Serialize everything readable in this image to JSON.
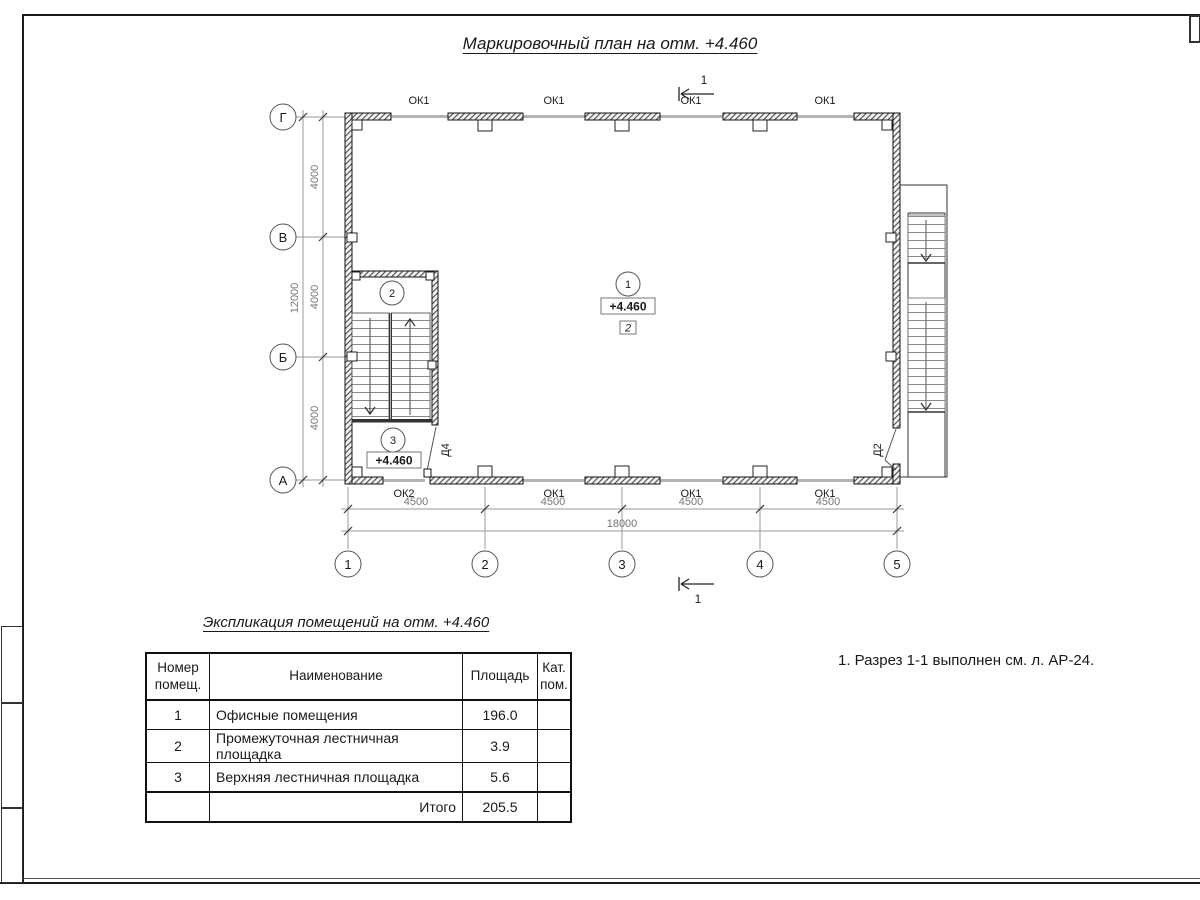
{
  "drawing": {
    "title": "Маркировочный план на отм. +4.460",
    "section_label": "1",
    "axes_rows": [
      "Г",
      "В",
      "Б",
      "А"
    ],
    "axes_cols": [
      "1",
      "2",
      "3",
      "4",
      "5"
    ],
    "dims_vertical": [
      "4000",
      "4000",
      "4000"
    ],
    "dim_vertical_total": "12000",
    "dims_horizontal": [
      "4500",
      "4500",
      "4500",
      "4500"
    ],
    "dim_horizontal_total": "18000",
    "windows_top": [
      "ОК1",
      "ОК1",
      "ОК1",
      "ОК1"
    ],
    "windows_bottom": [
      "ОК2",
      "ОК1",
      "ОК1",
      "ОК1"
    ],
    "door_left": "Д4",
    "door_right": "Д2",
    "room_office": "1",
    "room_mid_landing": "2",
    "room_upper_landing": "3",
    "elevation_main": "+4.460",
    "elevation_landing": "+4.460",
    "zone_mark": "2"
  },
  "schedule": {
    "title": "Экспликация помещений на отм. +4.460",
    "col_num": "Номер помещ.",
    "col_name": "Наименование",
    "col_area": "Площадь",
    "col_cat": "Кат. пом.",
    "rows": [
      {
        "num": "1",
        "name": "Офисные помещения",
        "area": "196.0",
        "cat": ""
      },
      {
        "num": "2",
        "name": "Промежуточная лестничная площадка",
        "area": "3.9",
        "cat": ""
      },
      {
        "num": "3",
        "name": "Верхняя лестничная площадка",
        "area": "5.6",
        "cat": ""
      }
    ],
    "total_label": "Итого",
    "total_area": "205.5"
  },
  "notes": {
    "note1": "1. Разрез 1-1 выполнен см. л. АР-24."
  }
}
